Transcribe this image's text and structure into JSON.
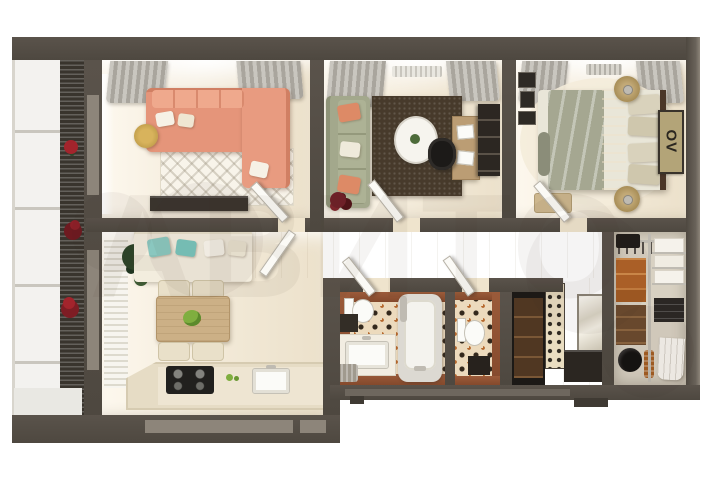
{
  "image": {
    "kind": "3d-floor-plan-render",
    "watermark_text": "АВИТО",
    "background": "#ffffff"
  },
  "bedroom": {
    "poster_text": "OV"
  },
  "palette": {
    "wall": "#5a534b",
    "wallDark": "#4e4840",
    "wallLight": "#8d857a",
    "floor": "#f2e9d7",
    "floorBright": "#fdf8ee",
    "hallFloor": "#efe4cd",
    "tileBase": "#ecdabd",
    "terracotta": "#9b5b3a",
    "coral": "#e5957a",
    "sage": "#a3a88c",
    "rugDark": "#473a2b",
    "teal": "#8fd0c8",
    "woodTable": "#ccb086",
    "counterCream": "#e6dcc5",
    "consoleDark": "#3a342e",
    "chrome": "#bfbbb2",
    "flowerRed": "#a3242c",
    "boxOrange": "#b06327",
    "bedOlive": "#a5a791",
    "sheetCream": "#e9e6d8",
    "runnerBrown": "#7a4628",
    "headboardBrown": "#4a3628",
    "posterTan": "#b3a478",
    "posterText": "#2b2720",
    "closetFloor": "#d8d1c2",
    "glazeWhite": "#f3f2ef",
    "railingDark": "#39342d",
    "plantGreen": "#2c452a",
    "doorWhite": "#fbfaf6"
  },
  "rooms": [
    {
      "name": "balcony",
      "items": [
        "glazing",
        "railing",
        "red-flower-planters"
      ]
    },
    {
      "name": "living-room",
      "items": [
        "coral-corner-sofa",
        "patterned-rug",
        "media-console",
        "side-table",
        "curtains"
      ]
    },
    {
      "name": "lounge-study",
      "items": [
        "sage-sofa",
        "coral-pillows",
        "dark-rug",
        "oval-coffee-table",
        "desk",
        "office-chair",
        "bookcase",
        "red-plant"
      ]
    },
    {
      "name": "bedroom",
      "items": [
        "double-bed",
        "patterned-runner",
        "nightstands-with-lamps",
        "ov-poster",
        "gallery-frames",
        "bench"
      ]
    },
    {
      "name": "kitchen-dining",
      "items": [
        "cream-sofa",
        "teal-pillows",
        "plant",
        "dining-table",
        "four-chairs",
        "counter",
        "stove",
        "sink"
      ]
    },
    {
      "name": "hallway",
      "items": [
        "open-doors",
        "wood-floor"
      ]
    },
    {
      "name": "bathroom",
      "items": [
        "bathtub",
        "toilet",
        "vanity-sink",
        "floret-tile",
        "laundry-basket"
      ]
    },
    {
      "name": "wc",
      "items": [
        "toilet",
        "floret-tile"
      ]
    },
    {
      "name": "entry",
      "items": [
        "mirror",
        "shoe-cabinet",
        "decorative-screen",
        "dark-niche-cabinet"
      ]
    },
    {
      "name": "walk-in-closet",
      "items": [
        "wire-shelving",
        "orange-boxes",
        "drawer-unit",
        "linens",
        "towels",
        "black-bag"
      ]
    }
  ]
}
